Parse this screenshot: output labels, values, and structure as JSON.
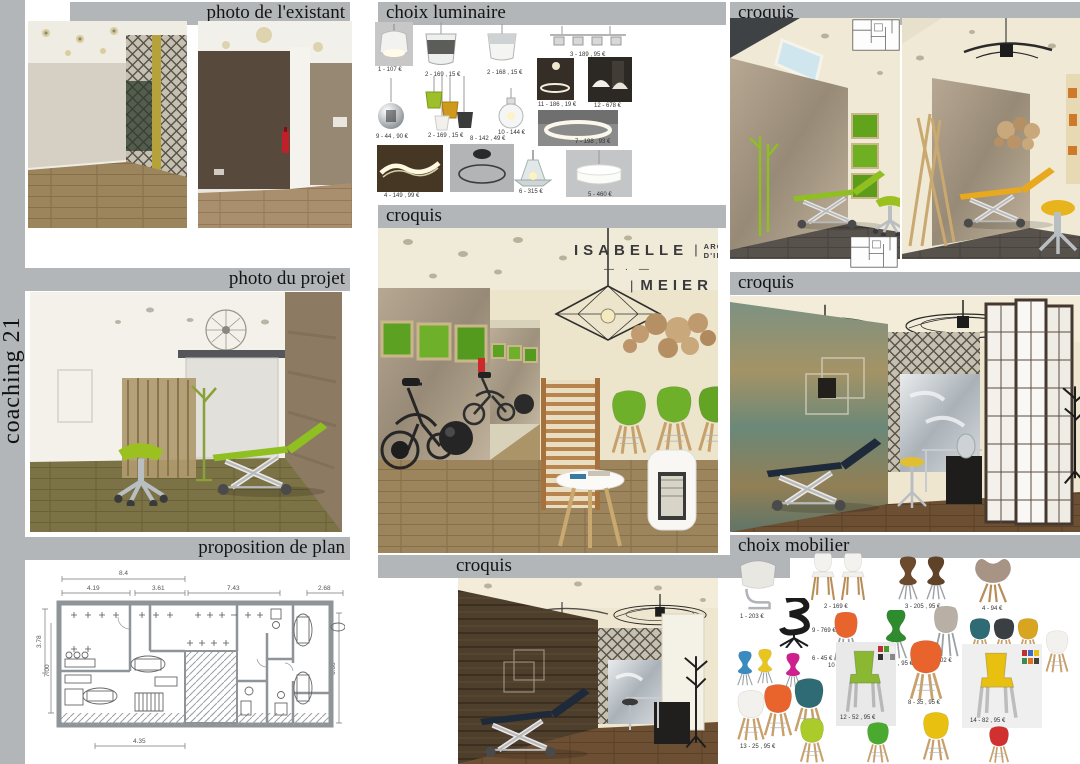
{
  "page": {
    "spine_title": "coaching 21"
  },
  "palette": {
    "header_bar": "#b2b6b9",
    "accent_green": "#8fbf21",
    "accent_yellow": "#e8a91e",
    "moss_green": "#6aaa1e",
    "navy": "#1e2a3a",
    "cream_wall": "#ece5cc",
    "wood_floor": "#9c855c"
  },
  "sections": {
    "photo_existant": {
      "title": "photo de l'existant"
    },
    "choix_luminaire": {
      "title": "choix luminaire",
      "items": [
        {
          "caption": "1 - 107 €"
        },
        {
          "caption": "2 - 169 , 15 €"
        },
        {
          "caption": "2 - 168 , 15 €"
        },
        {
          "caption": "3 - 189 , 95 €"
        },
        {
          "caption": "11 - 186 , 19 €"
        },
        {
          "caption": "12 - 678 €"
        },
        {
          "caption": "9 - 44 , 90 €"
        },
        {
          "caption": "2 - 169 , 15 €"
        },
        {
          "caption": "10 - 144 €"
        },
        {
          "caption": "7 - 198 , 93 €"
        },
        {
          "caption": "8 - 142 , 49 €"
        },
        {
          "caption": "4 - 149 , 99 €"
        },
        {
          "caption": "6 - 315 €"
        },
        {
          "caption": "5 - 460 €"
        }
      ]
    },
    "croquis_top_right": {
      "title": "croquis"
    },
    "croquis_center": {
      "title": "croquis"
    },
    "photo_projet": {
      "title": "photo du projet"
    },
    "croquis_mid_right": {
      "title": "croquis"
    },
    "proposition_plan": {
      "title": "proposition de plan",
      "dims_top": [
        "8.4",
        "4.19",
        "3.61",
        "7.43",
        "2.68"
      ],
      "dims_left": [
        "3.78",
        "7.00"
      ],
      "dims_right": [
        "6.60"
      ],
      "dims_bottom": [
        "4.35"
      ]
    },
    "croquis_bottom": {
      "title": "croquis"
    },
    "choix_mobilier": {
      "title": "choix mobilier",
      "items": [
        {
          "caption": "1 - 203 €"
        },
        {
          "caption": "2 - 169 €"
        },
        {
          "caption": "3 - 205 , 95 €"
        },
        {
          "caption": "4 - 94 €"
        },
        {
          "caption": "9 - 769 €"
        },
        {
          "caption": "10 - 25 , 95 €"
        },
        {
          "caption": "11 - 25 , 95 €"
        },
        {
          "caption": "7 - 102 €"
        },
        {
          "caption": "5 - 98 €"
        },
        {
          "caption": "6 - 45 €"
        },
        {
          "caption": "12 - 52 , 95 €"
        },
        {
          "caption": "8 - 35 , 95 €"
        },
        {
          "caption": "14 - 82 , 95 €"
        },
        {
          "caption": "13 - 25 , 95 €"
        }
      ]
    }
  },
  "logo": {
    "name_first": "ISABELLE",
    "name_last": "MEIER",
    "bar": "|",
    "subtitle_line1": "ARCHITECTE",
    "subtitle_line2": "D'INTÉRIEUR",
    "divider": "—  ·  —"
  }
}
